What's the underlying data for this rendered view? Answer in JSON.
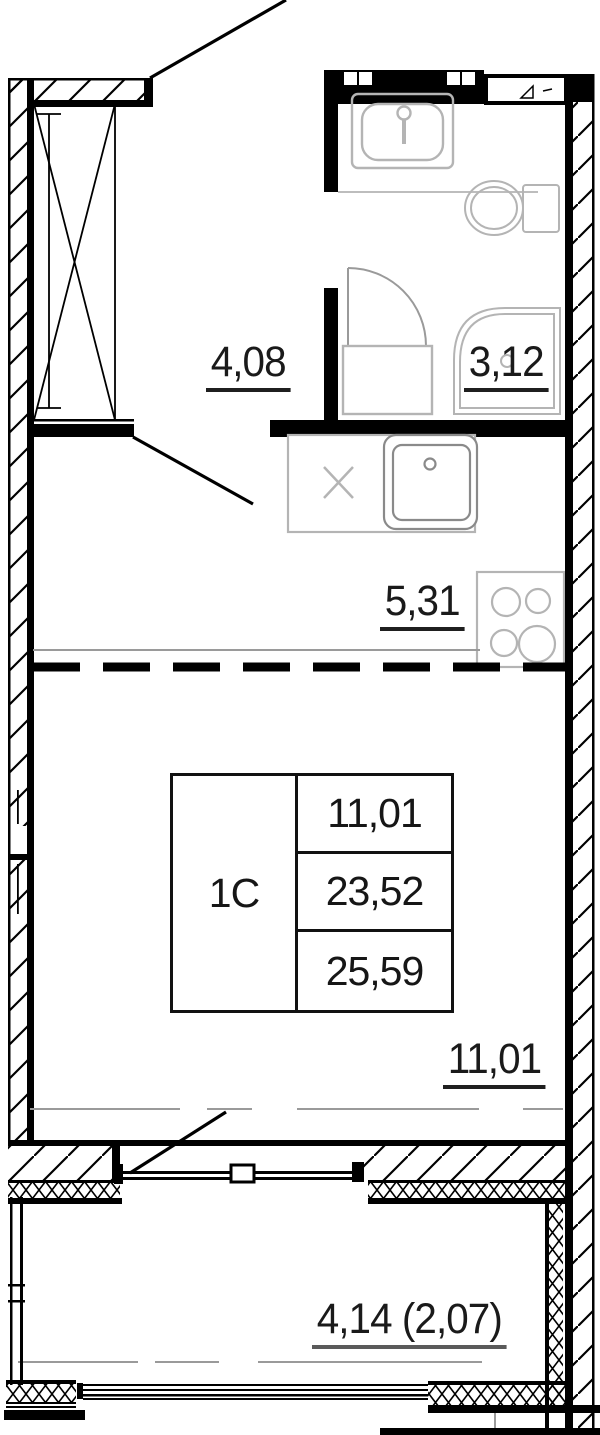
{
  "plan": {
    "rooms": {
      "hall": {
        "area": "4,08"
      },
      "bathroom": {
        "area": "3,12"
      },
      "kitchen": {
        "area": "5,31"
      },
      "living": {
        "area": "11,01"
      },
      "balcony": {
        "area": "4,14 (2,07)"
      }
    },
    "info_table": {
      "unit_type": "1С",
      "living_area": "11,01",
      "apartment_area": "23,52",
      "total_area": "25,59"
    },
    "colors": {
      "walls": "#000000",
      "fixtures": "#b4b4b4",
      "reference_lines": "#9a9a9a"
    }
  }
}
